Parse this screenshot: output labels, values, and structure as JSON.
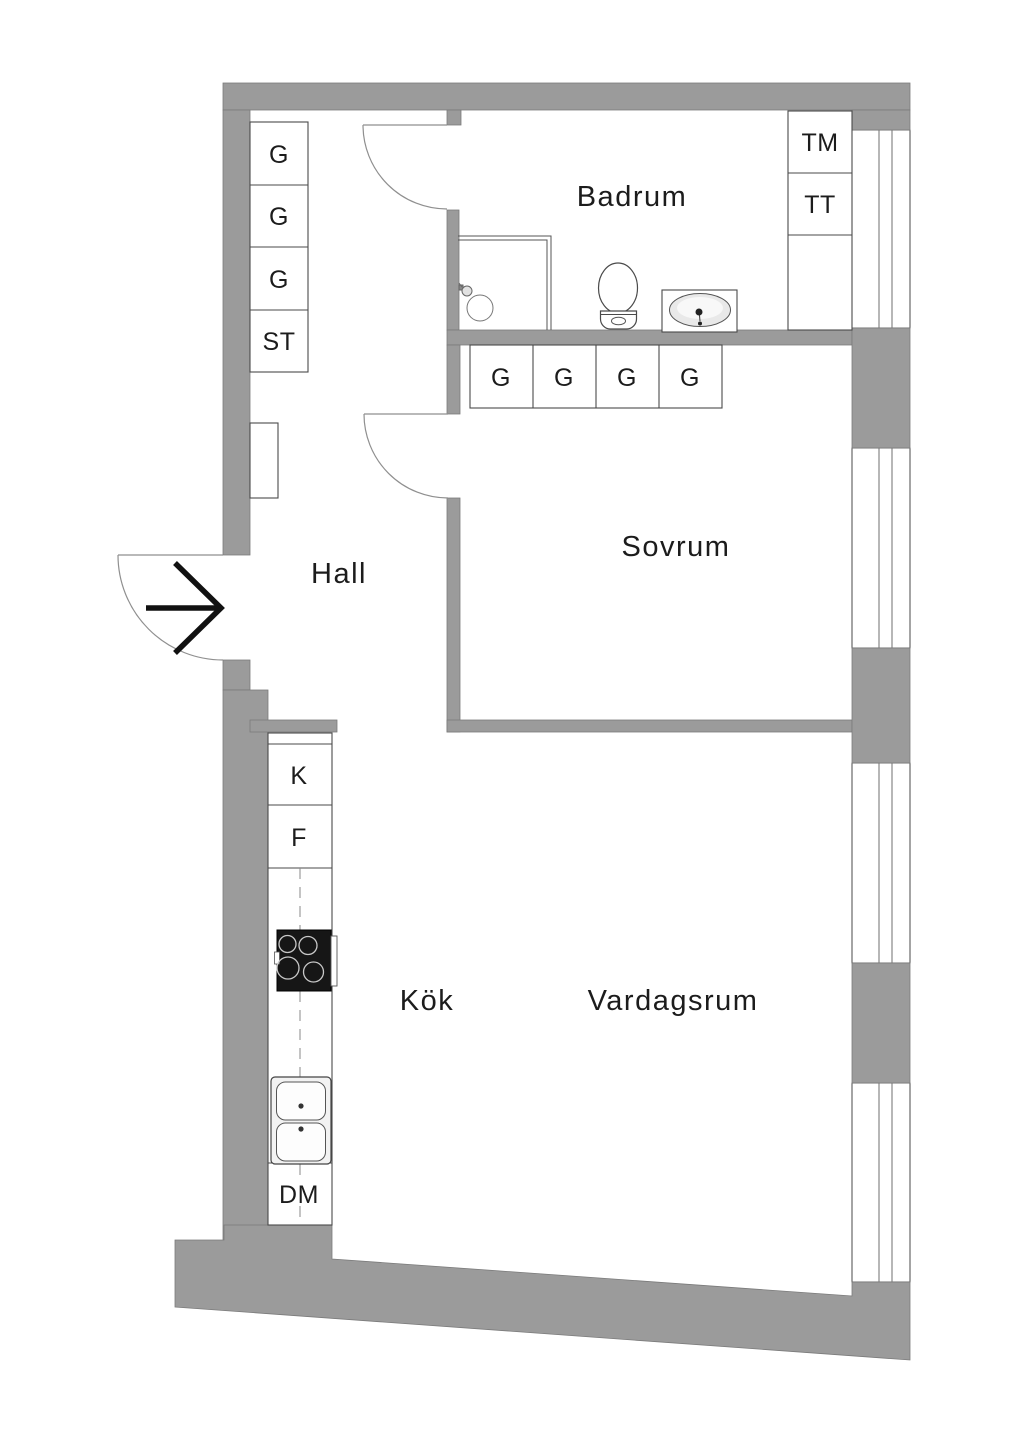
{
  "rooms": {
    "badrum": "Badrum",
    "sovrum": "Sovrum",
    "hall": "Hall",
    "kok": "Kök",
    "vardagsrum": "Vardagsrum"
  },
  "hall_closets": [
    "G",
    "G",
    "G",
    "ST"
  ],
  "sovrum_closets": [
    "G",
    "G",
    "G",
    "G"
  ],
  "laundry_units": [
    "TM",
    "TT"
  ],
  "kitchen_units": {
    "top": "K",
    "middle": "F",
    "bottom": "DM"
  },
  "icons": {
    "entry_arrow": "entry-direction-arrow",
    "doors": [
      "entry-door",
      "bathroom-door",
      "bedroom-door"
    ],
    "fixtures": [
      "shower",
      "toilet",
      "washbasin",
      "stove",
      "kitchen-sink",
      "radiator"
    ]
  },
  "colors": {
    "wall": "#9b9b9b",
    "wall_outline": "#7b7b7b",
    "line": "#4a4a4a",
    "door_line": "#8f8f8f",
    "window_glass_line": "#6f6f6f",
    "text": "#1c1c1c",
    "appliance": "#161616",
    "arrow": "#111111",
    "background": "#ffffff"
  }
}
